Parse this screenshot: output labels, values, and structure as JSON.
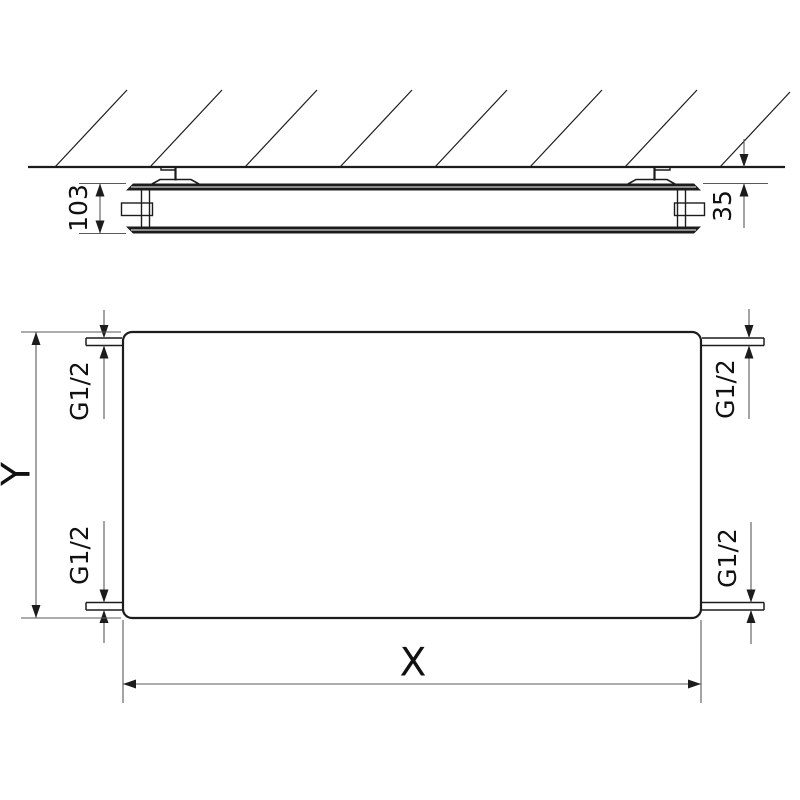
{
  "drawing": {
    "kind": "radiator-technical-dimension-drawing",
    "colors": {
      "geometry": "#1c1c1c",
      "dimension": "#5a5a5a",
      "text": "#111111",
      "background": "#ffffff"
    },
    "section_view": {
      "depth_label": "103",
      "clearance_label": "35"
    },
    "front_view": {
      "width_label": "X",
      "height_label": "Y",
      "connections": {
        "top_left": "G1/2",
        "bottom_left": "G1/2",
        "top_right": "G1/2",
        "bottom_right": "G1/2"
      }
    }
  }
}
